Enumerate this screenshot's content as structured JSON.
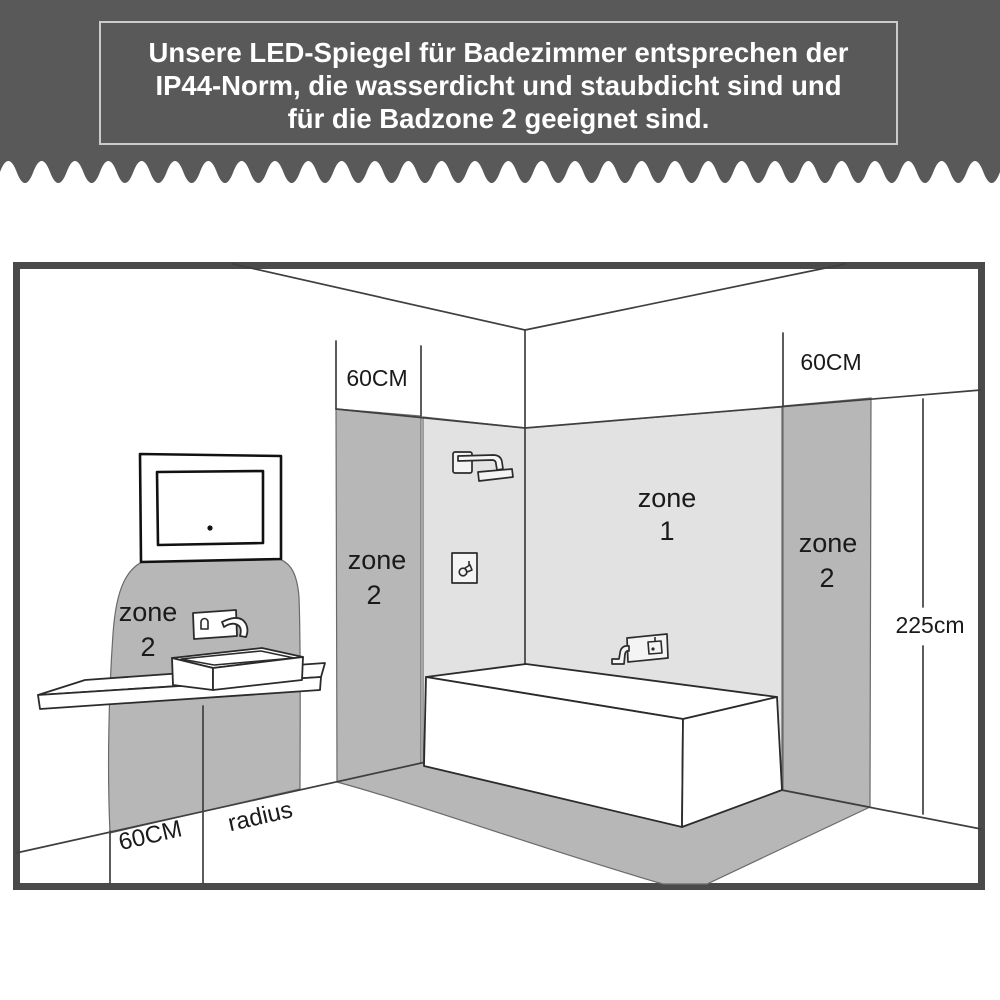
{
  "header": {
    "line1": "Unsere LED-Spiegel für Badezimmer entsprechen der",
    "line2": "IP44-Norm, die wasserdicht und staubdicht sind und",
    "line3": "für die Badzone 2 geeignet sind."
  },
  "diagram": {
    "measurements": {
      "left_wall_width": "60CM",
      "right_wall_width": "60CM",
      "wall_height": "225cm",
      "floor_width": "60CM",
      "floor_radius_label": "radius"
    },
    "zones": {
      "shower": {
        "word": "zone",
        "num": "1"
      },
      "left_wall_strip": {
        "word": "zone",
        "num": "2"
      },
      "right_wall_strip": {
        "word": "zone",
        "num": "2"
      },
      "washbasin": {
        "word": "zone",
        "num": "2"
      }
    },
    "colors": {
      "header_bg": "#595959",
      "zone2_fill": "#b7b7b7",
      "zone1_fill": "#e2e2e2",
      "outline": "#3f3f3f",
      "frame": "#4a4a4a"
    }
  }
}
